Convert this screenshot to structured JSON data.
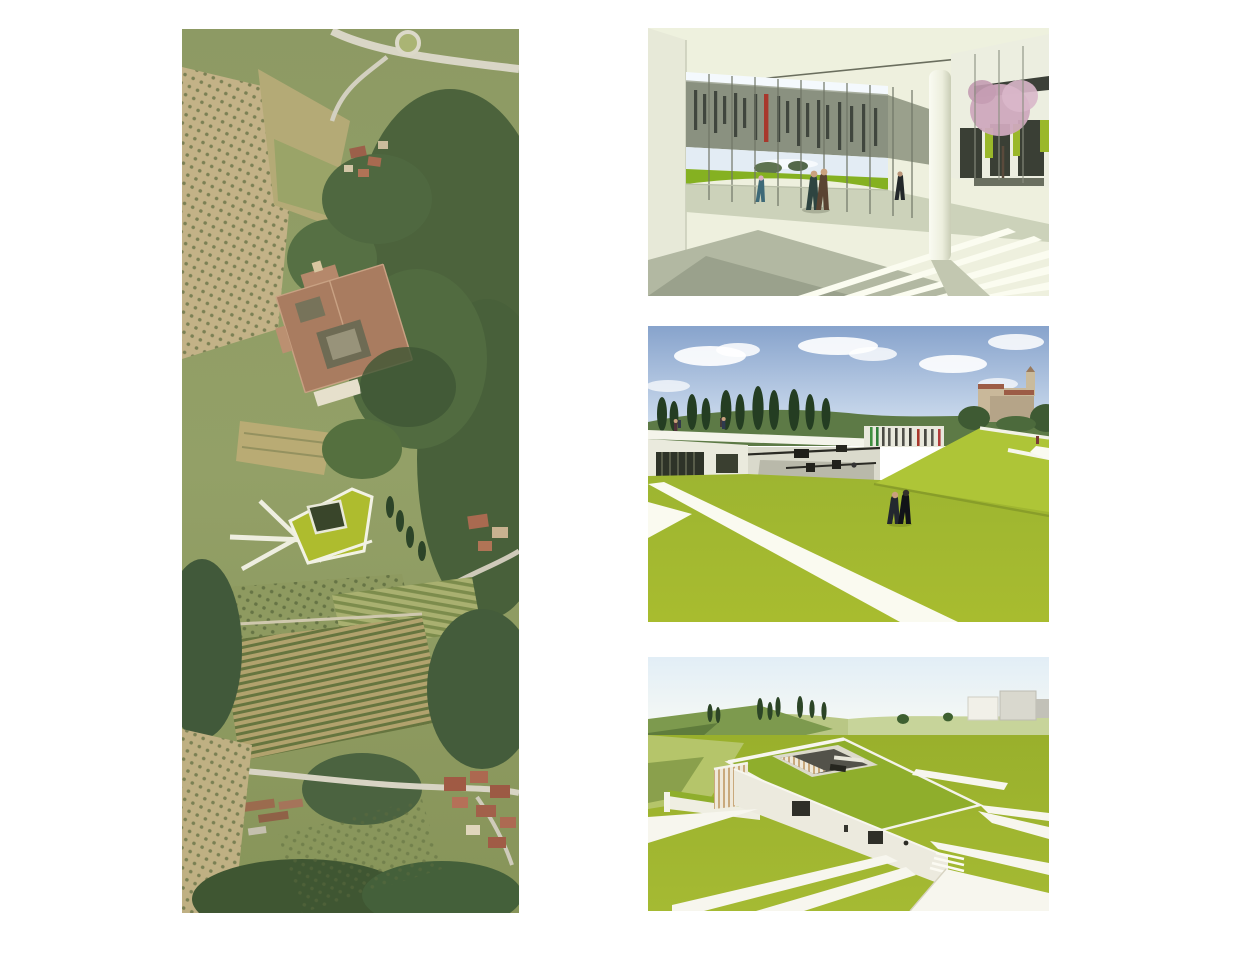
{
  "page": {
    "background": "#ffffff",
    "kind": "architecture presentation board, four borderless images on white"
  },
  "palette": {
    "accent_grass_green": "#a3ba30",
    "render_roof_green": "#8fae2c",
    "glass_band_gray": "#8a9180",
    "accent_red_stripe": "#a8372c",
    "accent_lime_panel": "#9ab82a",
    "sky_blue": "#8fa8cf",
    "pale_sky": "#e9f1f8",
    "white_wall": "#f2f1e6",
    "aerial_field_tan": "#c3b287",
    "aerial_forest_green": "#48603a",
    "monastery_roof_red": "#a97c60",
    "blossom_pink": "#cfa8bd"
  },
  "figures": {
    "aerial_photo": {
      "description": "Vertical aerial photograph of a Tuscan hillside: olive groves, terraced fields, a large monastery complex with cloister courtyards, woods, a photomontaged green-roof building with white paths, vineyards and village houses below"
    },
    "courtyard_render": {
      "description": "Rendering of a glazed courtyard: gray band facade with slender window slits and one red slit, white round column, dark panels with lime accents, pink flowering tree, green lawn strip beyond glass, sunlit striped paving and people"
    },
    "green_roof_render": {
      "description": "Rendering of sloped green roofscape with white diagonal paths, sunken white-walled courtyard, striped color facade, cypress row, distant hills and hilltown under blue sky with clouds, two people walking"
    },
    "aerial_render": {
      "description": "Aerial rendering of a bar-shaped building embedded in a green hillside with sunken courtyard, striped end facade, white wedge-shaped paths and pale distant hills with cypresses and white volumes"
    }
  }
}
